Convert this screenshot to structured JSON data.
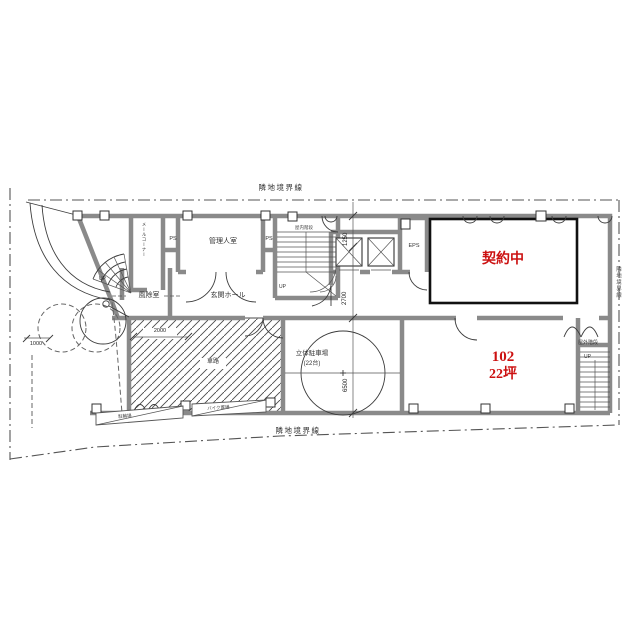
{
  "boundary": {
    "top": "隣地境界線",
    "bottom": "隣地境界線",
    "right": "隣地境界線"
  },
  "rooms": {
    "manager": "管理人室",
    "entrance_hall": "玄関ホール",
    "windbreak": "風除室",
    "mail_corner": "メールコーナー",
    "ps1": "PS",
    "ps2": "PS",
    "eps": "EPS",
    "indoor_stairs": "屋内階段",
    "contracted": "契約中",
    "unit_number": "102",
    "unit_area": "22坪",
    "parking": "立体駐車場",
    "parking_capacity": "(22台)",
    "driveway": "車路",
    "outdoor_stairs": "屋外階段",
    "bicycle_parking": "駐輪場",
    "bike_parking": "バイク置場"
  },
  "stairs": {
    "up_entrance": "UP",
    "up_indoor": "UP",
    "up_outdoor": "UP"
  },
  "dimensions": {
    "d1250": "1250",
    "d2700": "2700",
    "d6500": "6500",
    "d2000": "2000",
    "d1000": "1000"
  },
  "colors": {
    "accent_red": "#cc1111",
    "wall_gray": "#8a8a8a",
    "line": "#3c3c3c",
    "boundary": "#555555"
  }
}
